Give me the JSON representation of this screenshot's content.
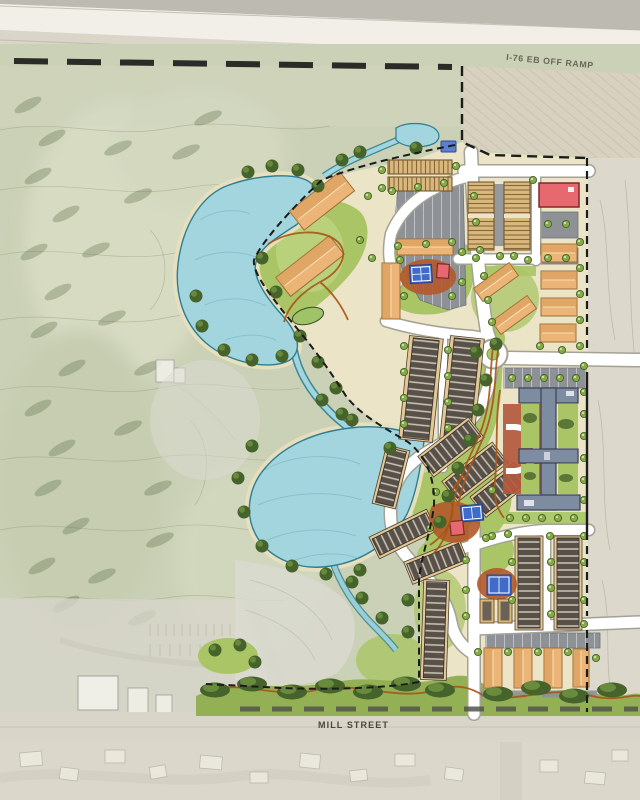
{
  "map": {
    "type": "illustrated master site plan",
    "labels": {
      "off_ramp": "I-76 EB OFF RAMP",
      "mill_street": "MILL STREET"
    },
    "colors": {
      "background": "#e9e5dc",
      "highway_median": "#bdbab1",
      "highway_pavement": "#f1efe8",
      "highway_shoulder": "#d9d5c9",
      "embankment": "#d8d1bf",
      "golf_turf": "#cbd1b6",
      "golf_contour": "#969c7e",
      "golf_tree": "#5f7049",
      "existing_ground": "#dcd8cb",
      "site_ground": "#ece4c6",
      "water": "#a2d5dd",
      "water_edge": "#2e7f92",
      "water_shade": "#7bbcc8",
      "shore_sand": "#e9dfbe",
      "lawn": "#a9c565",
      "lawn_light": "#c6d98c",
      "buffer_green": "#94b054",
      "tree_dark": "#47632c",
      "tree_mid": "#6d8f3f",
      "tree_light": "#86ab46",
      "road": "#ffffff",
      "road_casing": "#a3a296",
      "parking": "#8e9196",
      "parking_line": "#c9ccd0",
      "apartment": "#ecb577",
      "apartment_shade": "#d3944f",
      "apartment_stroke": "#9c6f38",
      "townhome_tan": "#d9b87e",
      "townhome_hatch": "#7a5a2c",
      "rowhome_base": "#e3c795",
      "rowhome_roof": "#57514a",
      "rowhome_ridge": "#cfc5b5",
      "school_fill": "#7e8ca2",
      "school_stroke": "#3a4251",
      "school_court": "#b2593d",
      "red_building": "#e5696e",
      "red_building_stroke": "#7c2b2e",
      "sport_court": "#3f6cc8",
      "sport_court_line": "#ffffff",
      "mulch": "#b2592a",
      "trail": "#a85417",
      "boundary": "#1c1c1a",
      "label_text": "#6a655a",
      "street_marking": "#54544e"
    }
  }
}
